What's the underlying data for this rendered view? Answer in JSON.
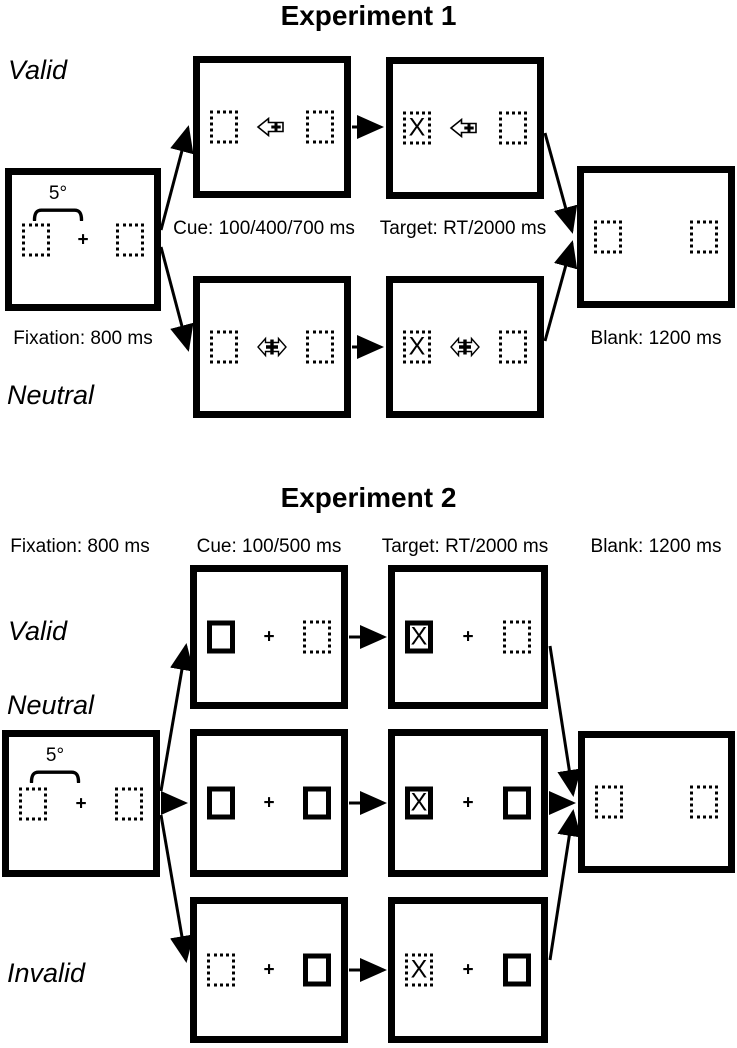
{
  "page": {
    "background": "#ffffff",
    "ink": "#000000"
  },
  "exp1": {
    "title": "Experiment 1",
    "valid_label": "Valid",
    "neutral_label": "Neutral",
    "fixation_caption": "Fixation: 800 ms",
    "cue_caption": "Cue: 100/400/700 ms",
    "target_caption": "Target: RT/2000 ms",
    "blank_caption": "Blank: 1200 ms",
    "separation_label": "5°",
    "fixation_cross": "+",
    "target_letter": "X",
    "valid_cue_symbol": "left-arrow-with-plus",
    "neutral_cue_symbol": "double-arrow-with-plus",
    "box_styles": {
      "fixation": {
        "left": "dotted",
        "right": "dotted"
      },
      "valid_cue": {
        "left": "dotted",
        "right": "dotted"
      },
      "valid_target": {
        "left": "dotted",
        "right": "dotted"
      },
      "neutral_cue": {
        "left": "dotted",
        "right": "dotted"
      },
      "neutral_target": {
        "left": "dotted",
        "right": "dotted"
      },
      "blank": {
        "left": "dotted",
        "right": "dotted"
      }
    }
  },
  "exp2": {
    "title": "Experiment 2",
    "fixation_caption": "Fixation: 800 ms",
    "cue_caption": "Cue: 100/500 ms",
    "target_caption": "Target: RT/2000 ms",
    "blank_caption": "Blank: 1200 ms",
    "separation_label": "5°",
    "fixation_cross": "+",
    "target_letter": "X",
    "rows": [
      {
        "label": "Valid",
        "cue_left": "solid",
        "cue_right": "dotted",
        "target_left": "solid",
        "target_right": "dotted"
      },
      {
        "label": "Neutral",
        "cue_left": "solid",
        "cue_right": "solid",
        "target_left": "solid",
        "target_right": "solid"
      },
      {
        "label": "Invalid",
        "cue_left": "dotted",
        "cue_right": "solid",
        "target_left": "dotted",
        "target_right": "solid"
      }
    ],
    "box_styles": {
      "fixation": {
        "left": "dotted",
        "right": "dotted"
      },
      "blank": {
        "left": "dotted",
        "right": "dotted"
      }
    }
  }
}
